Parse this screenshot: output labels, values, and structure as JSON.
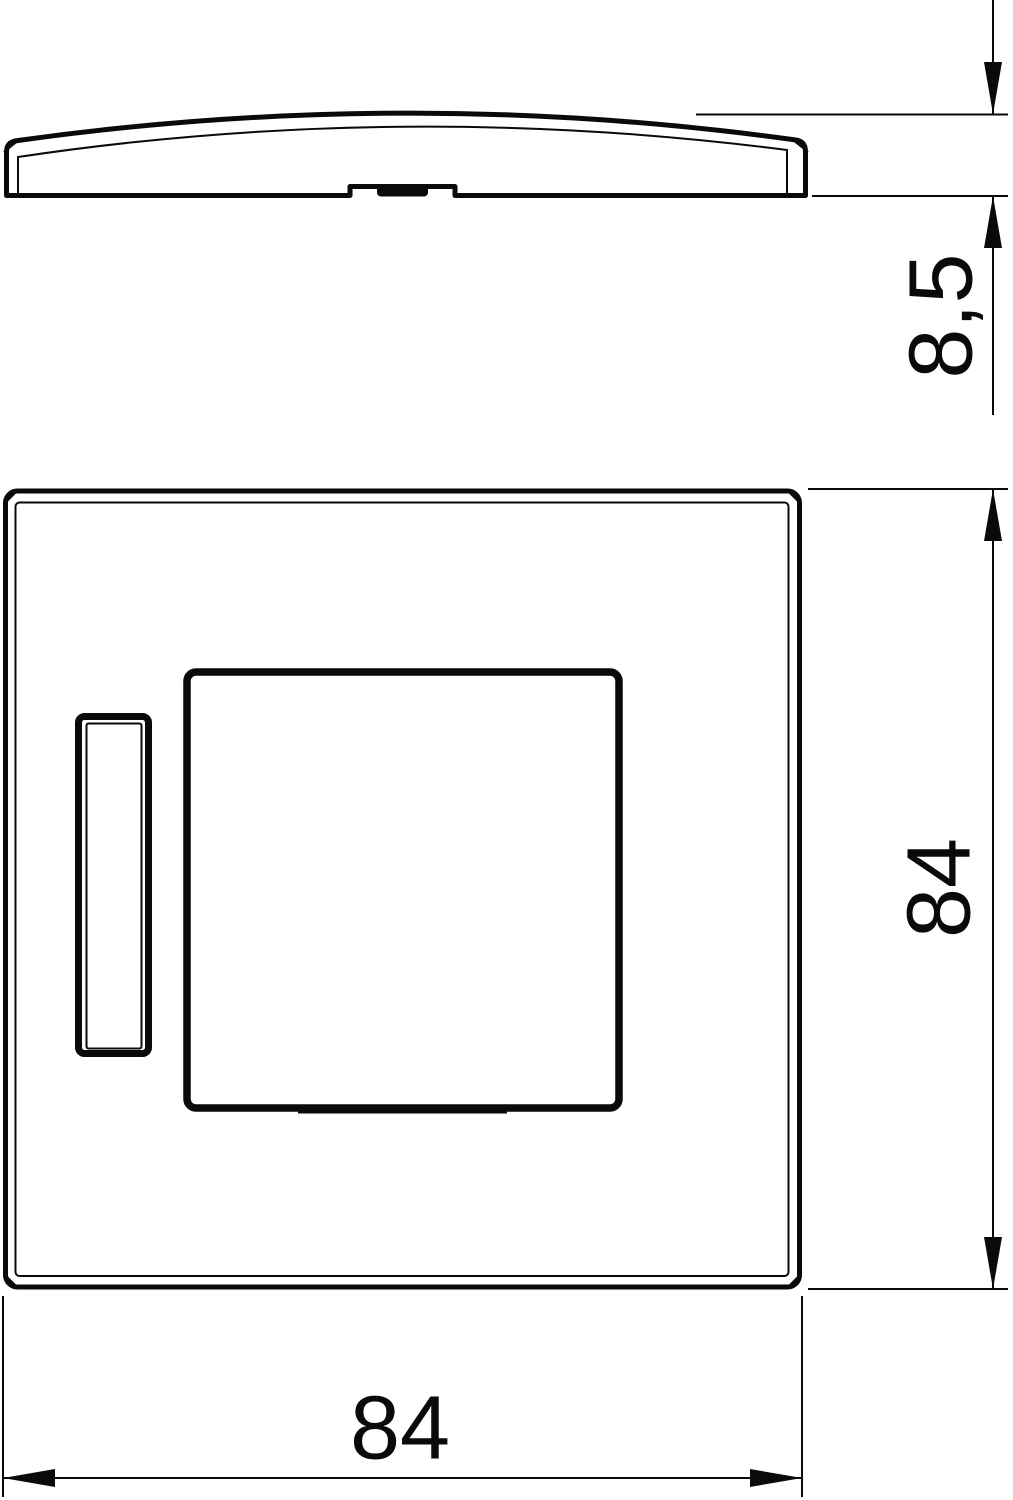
{
  "colors": {
    "background": "#ffffff",
    "line": "#0a0a0a"
  },
  "dimensions": {
    "thickness": {
      "label": "8,5"
    },
    "height": {
      "label": "84"
    },
    "width": {
      "label": "84"
    }
  }
}
